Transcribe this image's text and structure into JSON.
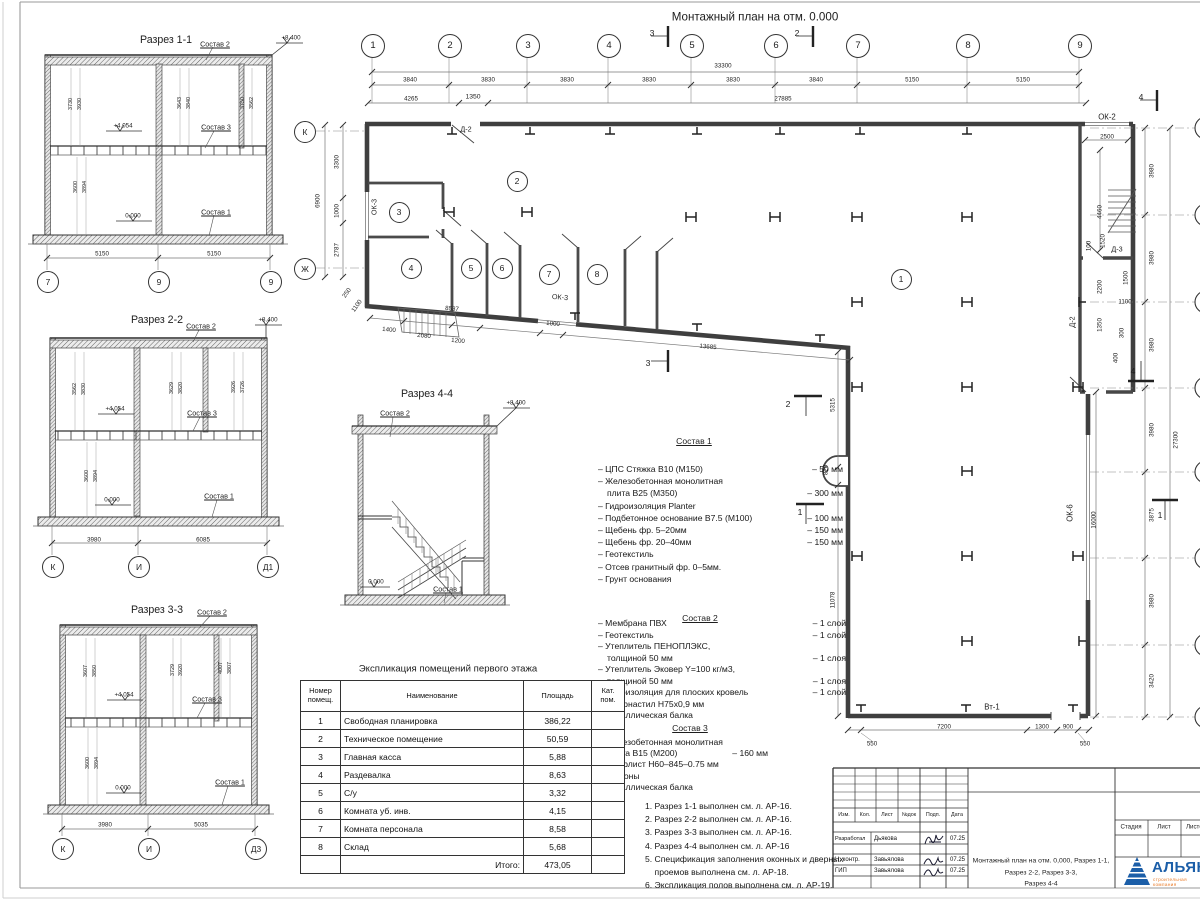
{
  "plan": {
    "title": "Монтажный план на отм. 0.000",
    "axes_top": [
      "1",
      "2",
      "3",
      "4",
      "5",
      "6",
      "7",
      "8",
      "9"
    ],
    "axes_left": [
      "К",
      "Ж"
    ],
    "dims_top": [
      "3840",
      "3830",
      "3830",
      "3830",
      "3830",
      "3840",
      "5150",
      "5150"
    ],
    "dim_total_top": "33300",
    "dims_top2": [
      "4265",
      "1350",
      "27885"
    ],
    "dims_left": [
      "6900",
      "3300",
      "1000",
      "2787",
      "250",
      "1100"
    ],
    "dims_slant": [
      "1400",
      "2080",
      "1200",
      "8537",
      "1000",
      "13685"
    ],
    "dims_inner": [
      "5315",
      "820",
      "11078"
    ],
    "dims_bottom": [
      "550",
      "7200",
      "1300",
      "900",
      "550"
    ],
    "dims_wing": [
      "2500",
      "4460",
      "100",
      "1520",
      "1500",
      "2200",
      "1100",
      "1350",
      "300",
      "400"
    ],
    "dims_right": [
      "3980",
      "3980",
      "3980",
      "3980",
      "3875",
      "3980",
      "3420"
    ],
    "dim_right_inner": "16000",
    "dim_right_total": "27300",
    "rooms": [
      "1",
      "2",
      "3",
      "4",
      "5",
      "6",
      "7",
      "8"
    ],
    "labels": {
      "d2a": "Д-2",
      "ok3a": "ОК-3",
      "ok3b": "ОК-3",
      "ok2": "ОК-2",
      "d3": "Д-3",
      "d2b": "Д-2",
      "ok6": "ОК-6",
      "vt1": "Вт-1"
    },
    "section_marks": {
      "m1": "1",
      "m2": "2",
      "m3": "3",
      "m4": "4"
    }
  },
  "sections": {
    "s11": {
      "title": "Разрез 1-1",
      "top": "+8.400",
      "mid": "+4.054",
      "zero": "0.000",
      "c1": "Состав 1",
      "c2": "Состав 2",
      "c3": "Состав 3",
      "dims_up": [
        "3730",
        "3930",
        "3643",
        "3840",
        "3750",
        "3562"
      ],
      "dims_low": [
        "3894",
        "3600"
      ],
      "dims_bot": [
        "5150",
        "5150"
      ],
      "axes": [
        "7",
        "9",
        "9"
      ]
    },
    "s22": {
      "title": "Разрез 2-2",
      "top": "+8.400",
      "mid": "+4.054",
      "zero": "0.000",
      "c1": "Состав 1",
      "c2": "Состав 2",
      "c3": "Состав 3",
      "dims_up": [
        "3562",
        "3830",
        "3629",
        "3820",
        "3926",
        "3726"
      ],
      "dims_low": [
        "3894",
        "3600"
      ],
      "dims_bot": [
        "3980",
        "6085"
      ],
      "axes": [
        "К",
        "И",
        "Д1"
      ]
    },
    "s33": {
      "title": "Разрез 3-3",
      "mid": "+4.054",
      "zero": "0.000",
      "c1": "Состав 1",
      "c2": "Состав 2",
      "c3": "Состав 3",
      "dims_up": [
        "3607",
        "3850",
        "3729",
        "3920",
        "4007",
        "3807"
      ],
      "dims_low": [
        "3894",
        "3600"
      ],
      "dims_bot": [
        "3980",
        "5035"
      ],
      "axes": [
        "К",
        "И",
        "Д3"
      ]
    },
    "s44": {
      "title": "Разрез 4-4",
      "top": "+8.400",
      "zero": "0.000",
      "c1": "Состав 1",
      "c2": "Состав 2"
    }
  },
  "sostav1": {
    "title": "Состав 1",
    "items": [
      {
        "t": "– ЦПС Стяжка В10 (М150)",
        "v": "– 50 мм"
      },
      {
        "t": "– Железобетонная монолитная"
      },
      {
        "t": "плита В25 (М350)",
        "v": "– 300 мм",
        "i": 1
      },
      {
        "t": "– Гидроизоляция  Planter"
      },
      {
        "t": "– Подбетонное основание В7.5 (М100)",
        "v": "– 100 мм"
      },
      {
        "t": "– Щебень фр. 5–20мм",
        "v": "– 150 мм"
      },
      {
        "t": "– Щебень фр. 20–40мм",
        "v": "– 150 мм"
      },
      {
        "t": "– Геотекстиль"
      },
      {
        "t": "– Отсев гранитный фр. 0–5мм."
      },
      {
        "t": "– Грунт основания"
      }
    ]
  },
  "sostav2": {
    "title": "Состав 2",
    "items": [
      {
        "t": "– Мембрана ПВХ",
        "v": "– 1 слой"
      },
      {
        "t": "– Геотекстиль",
        "v": "– 1 слой"
      },
      {
        "t": "– Утеплитель ПЕНОПЛЭКС,"
      },
      {
        "t": "толщиной 50 мм",
        "v": "– 1 слоя",
        "i": 1
      },
      {
        "t": "– Утеплитель Эковер Y=100 кг/м3,"
      },
      {
        "t": "толщиной 50 мм",
        "v": "– 1 слоя",
        "i": 1
      },
      {
        "t": "– Пароизоляция для плоских кровель",
        "v": "– 1 слой"
      },
      {
        "t": "– Профнастил Н75х0,9 мм"
      },
      {
        "t": "– Металлическая балка"
      }
    ]
  },
  "sostav3": {
    "title": "Состав 3",
    "items": [
      {
        "t": "– Железобетонная монолитная"
      },
      {
        "t": "плита В15 (М200)",
        "v": "– 160 мм",
        "i": 1
      },
      {
        "t": "– Профлист Н60–845–0.75 мм"
      },
      {
        "t": "– Прогоны"
      },
      {
        "t": "– Металлическая балка"
      }
    ]
  },
  "notes": [
    "1. Разрез 1-1 выполнен см. л. АР-16.",
    "2. Разрез 2-2 выполнен см. л. АР-16.",
    "3. Разрез 3-3 выполнен см. л. АР-16.",
    "4. Разрез 4-4 выполнен см. л. АР-16",
    "5. Спецификация заполнения оконных и дверных",
    "    проемов выполнена см. л. АР-18.",
    "6. Экспликация полов выполнена см. л. АР-19."
  ],
  "table": {
    "title": "Экспликация помещений первого этажа",
    "headers": [
      "Номер помещ.",
      "Наименование",
      "Площадь",
      "Кат. пом."
    ],
    "rows": [
      [
        "1",
        "Свободная планировка",
        "386,22"
      ],
      [
        "2",
        "Техническое помещение",
        "50,59"
      ],
      [
        "3",
        "Главная касса",
        "5,88"
      ],
      [
        "4",
        "Раздевалка",
        "8,63"
      ],
      [
        "5",
        "С/у",
        "3,32"
      ],
      [
        "6",
        "Комната уб. инв.",
        "4,15"
      ],
      [
        "7",
        "Комната персонала",
        "8,58"
      ],
      [
        "8",
        "Склад",
        "5,68"
      ]
    ],
    "total_label": "Итого:",
    "total": "473,05"
  },
  "stamp": {
    "cols": [
      "Изм.",
      "Кол.",
      "Лист",
      "№док",
      "Подп.",
      "Дата"
    ],
    "rows": [
      {
        "role": "Разработал",
        "name": "Дьякова",
        "date": "07.25"
      },
      {
        "role": "Н. контр.",
        "name": "Завьялова",
        "date": "07.25"
      },
      {
        "role": "ГИП",
        "name": "Завьялова",
        "date": "07.25"
      }
    ],
    "doc_lines": [
      "Монтажный план на отм. 0,000, Разрез 1-1,",
      "Разрез 2-2, Разрез 3-3,",
      "Разрез 4-4"
    ],
    "right_cols": [
      "Стадия",
      "Лист",
      "Листов"
    ],
    "logo": "АЛЬЯНС",
    "logo_sub": "строительная компания"
  }
}
